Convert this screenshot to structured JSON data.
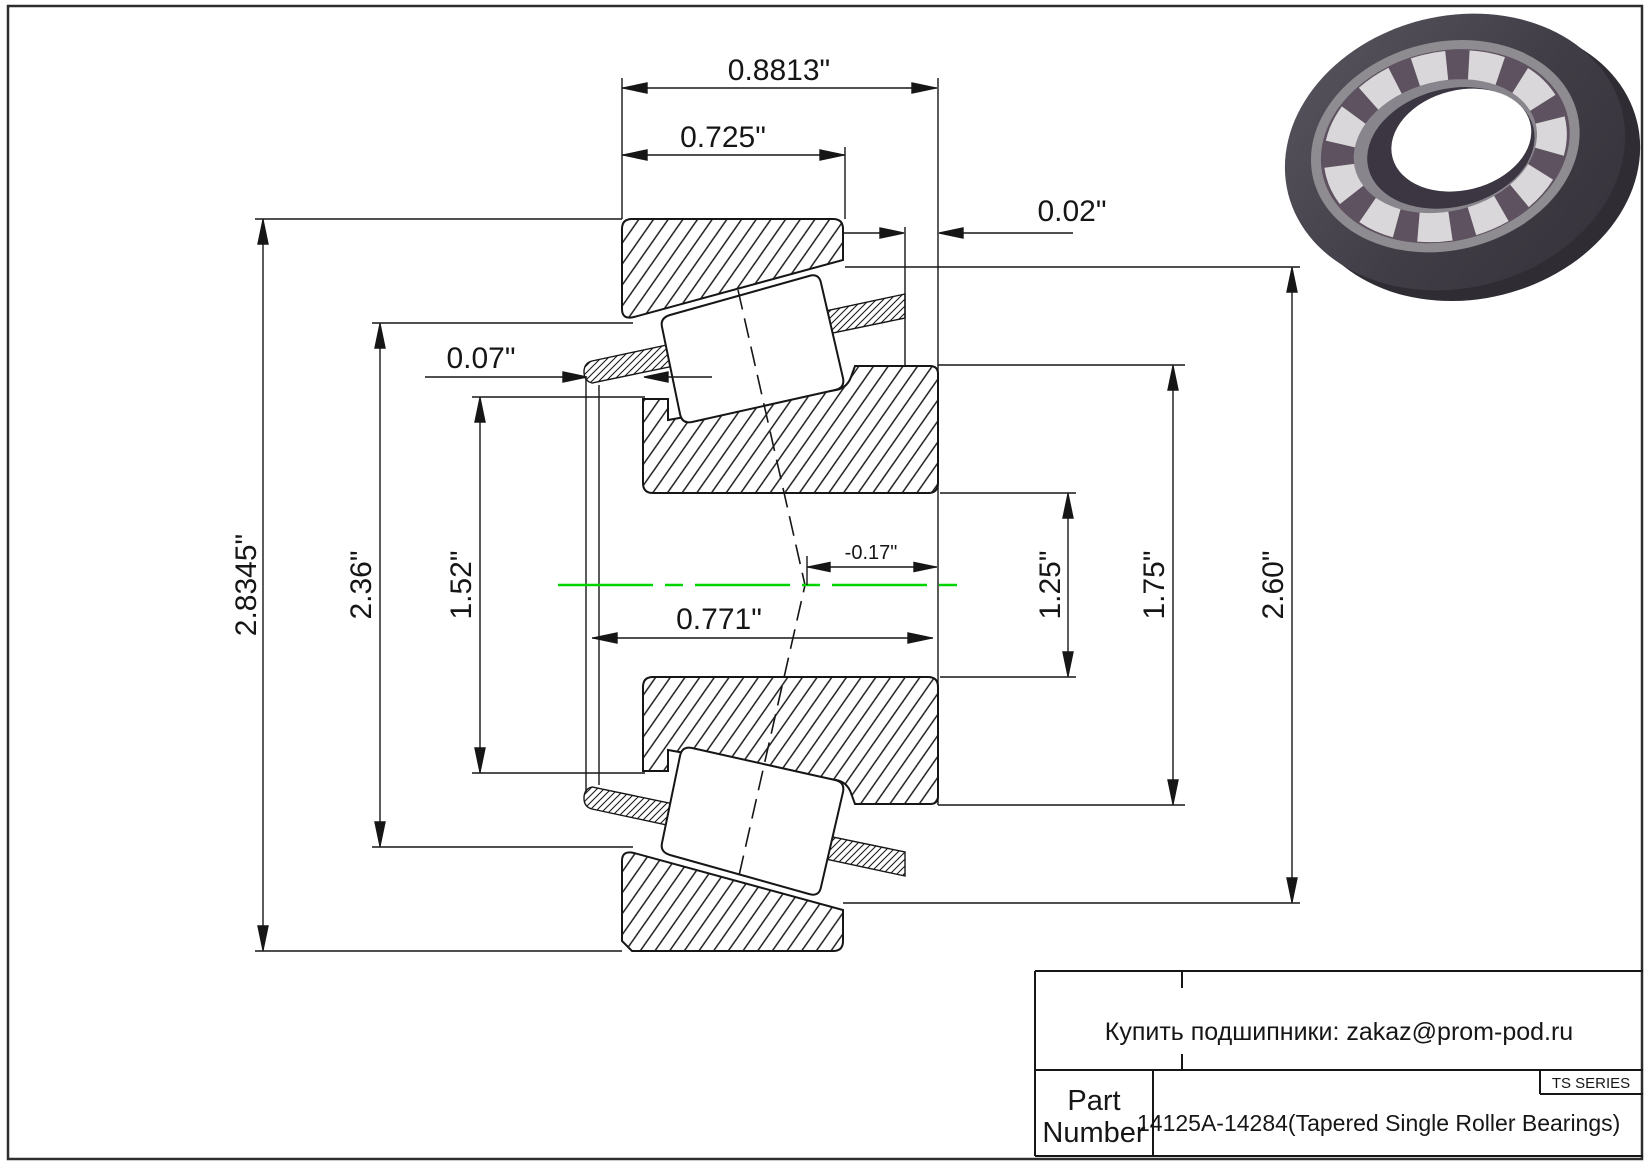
{
  "drawing": {
    "dims": {
      "overall_width": "0.8813\"",
      "cup_width": "0.725\"",
      "backface_stickout": "0.02\"",
      "cage_lip": "0.07\"",
      "outer_diameter": "2.8345\"",
      "cup_front_diameter": "2.36\"",
      "front_rib_diameter": "1.52\"",
      "cone_width": "0.771\"",
      "load_center": "-0.17\"",
      "bore_diameter": "1.25\"",
      "back_rib_diameter": "1.75\"",
      "shoulder_diameter": "2.60\""
    }
  },
  "title_block": {
    "contact": "Купить подшипники: zakaz@prom-pod.ru",
    "series_label": "TS SERIES",
    "part_label_line1": "Part",
    "part_label_line2": "Number",
    "part_number": "14125A-14284(Tapered Single Roller Bearings)"
  },
  "colors": {
    "centerline": "#00D400",
    "linework": "#1a1a1a"
  }
}
